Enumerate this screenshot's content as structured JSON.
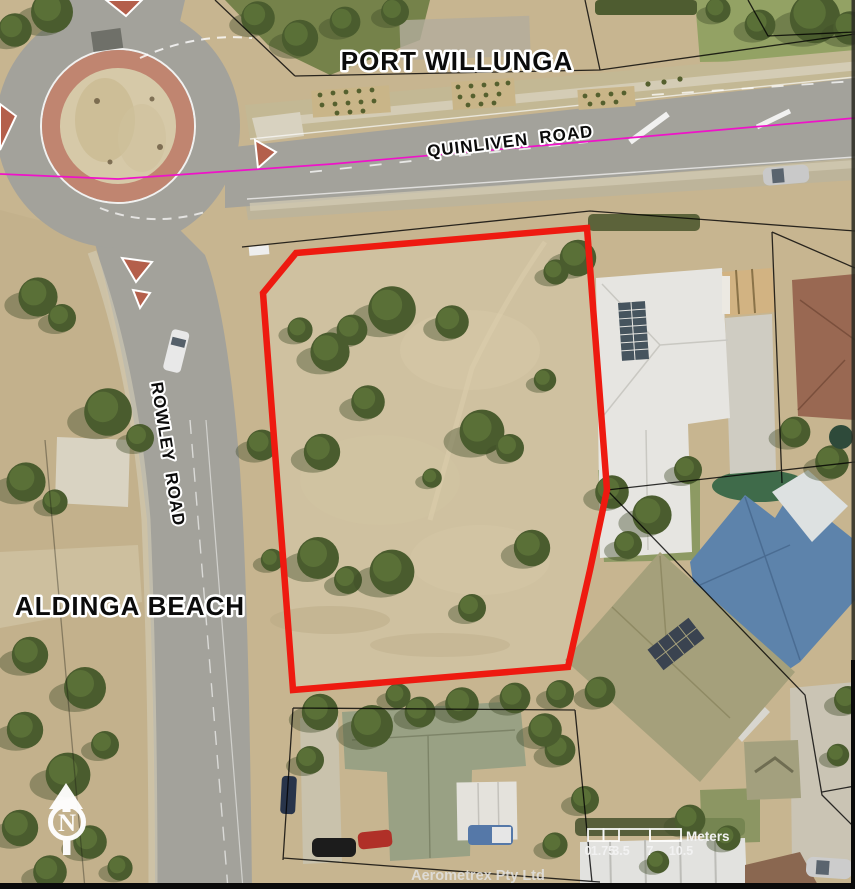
{
  "map": {
    "suburb_labels": {
      "top": "PORT WILLUNGA",
      "left": "ALDINGA BEACH"
    },
    "road_labels": {
      "quinliven": "QUINLIVEN  ROAD",
      "rowley": "ROWLEY  ROAD"
    },
    "north_arrow_letter": "N",
    "scale_bar": {
      "tick_labels": [
        "0",
        "1.75",
        "3.5",
        "7",
        "10.5"
      ],
      "unit_label": "Meters"
    },
    "attribution": "Aerometrex Pty Ltd",
    "legend_colors": {
      "subject_parcel_outline": "#ee1a10",
      "boundary_overlay_line": "#ef12c9",
      "cadastre_line": "#000000"
    }
  }
}
